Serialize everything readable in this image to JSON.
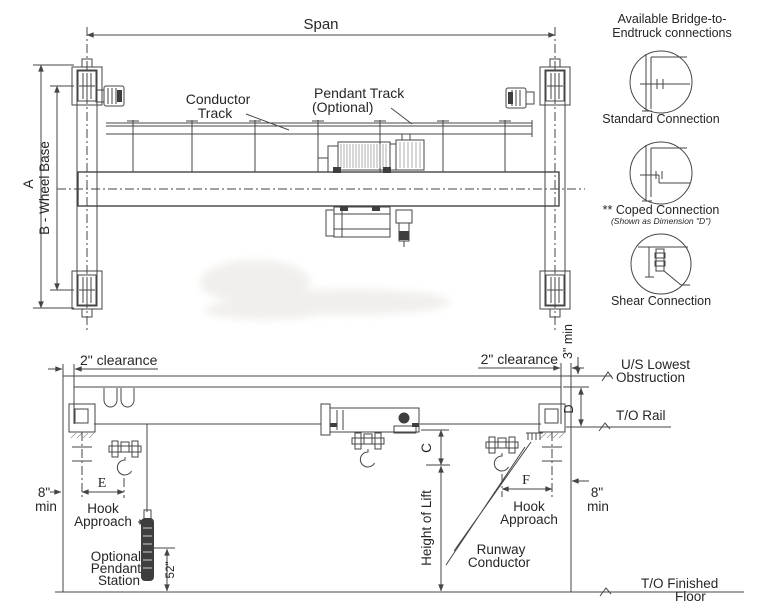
{
  "plan_view": {
    "span_label": "Span",
    "dim_a_label": "A",
    "wheel_base_label": "B - Wheel Base",
    "conductor_track_label": {
      "line1": "Conductor",
      "line2": "Track"
    },
    "pendant_track_label": {
      "line1": "Pendant Track",
      "line2": "(Optional)"
    }
  },
  "connections_panel": {
    "title": {
      "line1": "Available Bridge-to-",
      "line2": "Endtruck connections"
    },
    "standard_connection_label": "Standard Connection",
    "coped_connection_label": "** Coped Connection",
    "coped_connection_note": "(Shown as Dimension \"D\")",
    "shear_connection_label": "Shear Connection"
  },
  "elevation_view": {
    "clearance_left_label": "2\" clearance",
    "clearance_right_label": "2\" clearance",
    "min_clearance_label": "3\" min",
    "us_lowest_obstruction_label": {
      "line1": "U/S Lowest",
      "line2": "Obstruction"
    },
    "top_of_rail_label": "T/O Rail",
    "dim_d_label": "D",
    "dim_c_label": "C",
    "dim_e_label": "E",
    "dim_f_label": "F",
    "min_8_left": {
      "line1": "8\"",
      "line2": "min"
    },
    "min_8_right": {
      "line1": "8\"",
      "line2": "min"
    },
    "hook_approach_left": {
      "line1": "Hook",
      "line2": "Approach"
    },
    "hook_approach_right": {
      "line1": "Hook",
      "line2": "Approach"
    },
    "height_of_lift_label": "Height of Lift",
    "optional_pendant_station": {
      "line1": "Optional",
      "line2": "Pendant",
      "line3": "Station"
    },
    "pendant_height_label": "52\"",
    "runway_conductor_label": {
      "line1": "Runway",
      "line2": "Conductor"
    },
    "top_of_finished_floor_label": {
      "line1": "T/O Finished",
      "line2": "Floor"
    }
  },
  "colors": {
    "line": "#454545",
    "text": "#262626",
    "background": "#ffffff",
    "watermark": "#e9e7e2"
  }
}
